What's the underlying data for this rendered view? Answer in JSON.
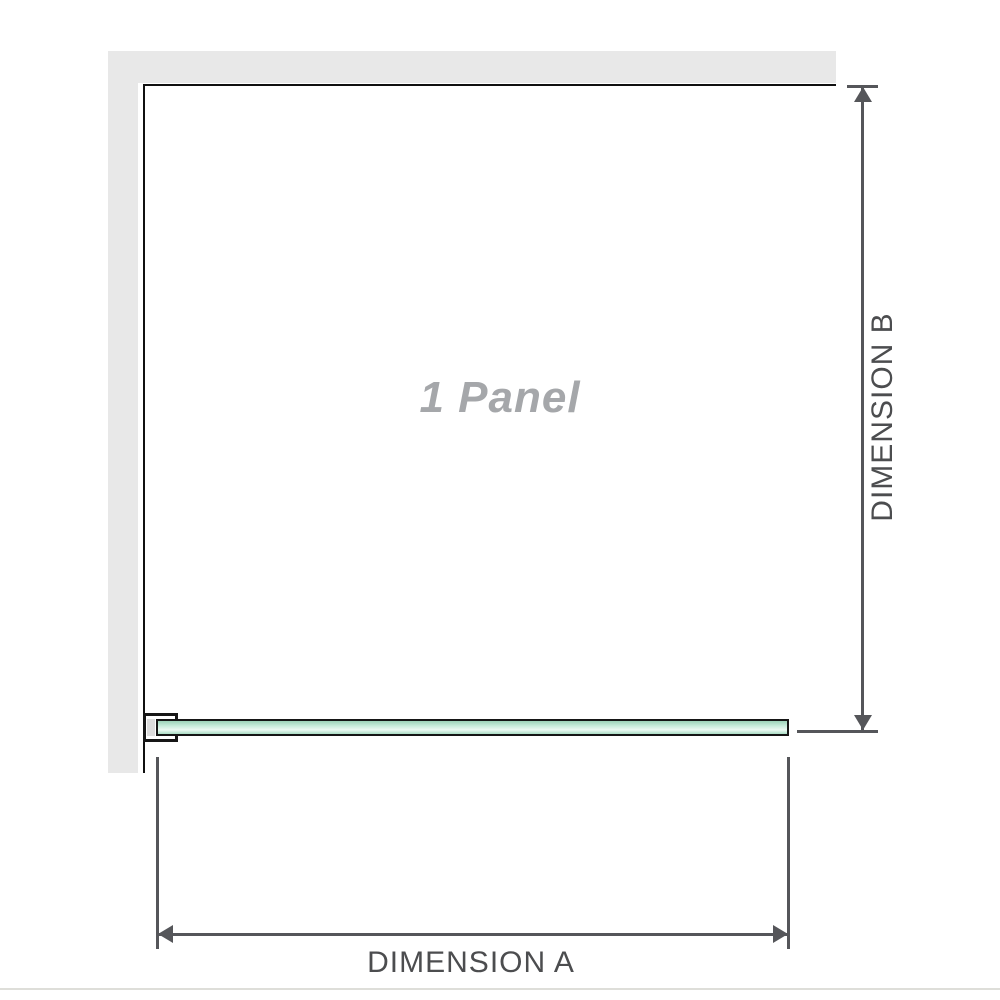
{
  "diagram": {
    "panel_label": "1 Panel",
    "dimension_a": {
      "label": "DIMENSION A",
      "orientation": "horizontal",
      "measures": "panel width"
    },
    "dimension_b": {
      "label": "DIMENSION B",
      "orientation": "vertical",
      "measures": "panel depth"
    }
  },
  "colors": {
    "wall_fill": "#e8e8e8",
    "wall_edge_line": "#101010",
    "glass_border": "#161616",
    "glass_green_dark": "#9cd2b8",
    "glass_green_mid": "#c9ecdc",
    "glass_green_light": "#edf9f3",
    "glass_green_bottom": "#aaddc4",
    "bracket_fill": "#ffffff",
    "bracket_inner": "#dcdcdc",
    "dimension_line": "#55565a",
    "dimension_label": "#4c4d4f",
    "panel_label_color": "#a5a7aa",
    "separator": "#deded9"
  }
}
